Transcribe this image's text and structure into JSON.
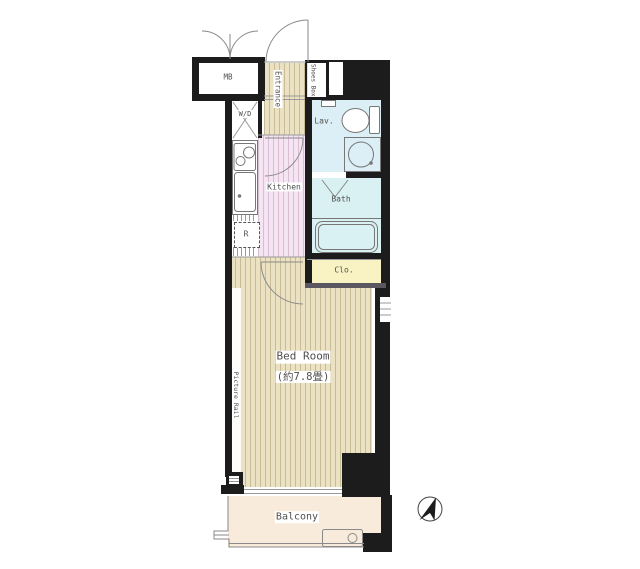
{
  "rooms": {
    "meter_box": "MB",
    "entrance": "Entrance",
    "shoes_box": "Shoes Box",
    "washer_dryer": "W/D",
    "kitchen": "Kitchen",
    "refrigerator": "R",
    "lavatory": "Lav.",
    "bath": "Bath",
    "closet": "Clo.",
    "bedroom_name": "Bed Room",
    "bedroom_size": "(約7.8畳)",
    "picture_rail": "Picture Rail",
    "balcony": "Balcony"
  },
  "icons": {
    "compass": "north-arrow-icon",
    "toilet": "toilet-icon",
    "washbasin": "washbasin-icon",
    "bathtub": "bathtub-icon",
    "stove": "stove-burners-icon",
    "sink": "kitchen-sink-icon",
    "washer_space": "washer-dryer-cross-icon",
    "doors": "door-swing-arc-icon"
  },
  "colors": {
    "wall": "#1c1c1c",
    "floor_wood": "#ebe1c3",
    "stripe_wood": "#c8bb95",
    "floor_kitchen": "#f5e4f2",
    "stripe_kitchen": "#d9bdd5",
    "floor_lav": "#dceff6",
    "floor_bath": "#d9f1f2",
    "floor_closet": "#f9f3c4",
    "floor_shoes": "#ebe4b2",
    "floor_balcony": "#f9ebdb",
    "label_text": "#4f4f4f",
    "line": "#8a8a8a"
  }
}
